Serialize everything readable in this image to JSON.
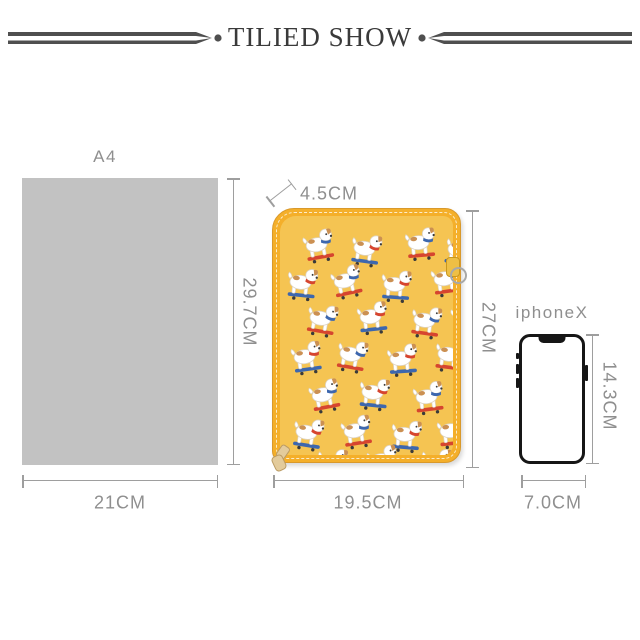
{
  "header": {
    "title": "TILIED SHOW"
  },
  "items": {
    "a4": {
      "name": "A4",
      "width_label": "21CM",
      "height_label": "29.7CM"
    },
    "case": {
      "thickness_label": "4.5CM",
      "width_label": "19.5CM",
      "height_label": "27CM",
      "pattern_description": "white terrier dogs riding red and blue skateboards on mustard yellow fabric"
    },
    "phone": {
      "name": "iphoneX",
      "width_label": "7.0CM",
      "height_label": "14.3CM"
    }
  },
  "icons": {
    "divider": "double-rule-with-arrow-and-dot",
    "d_ring": "metal-d-ring",
    "zipper_pull": "fabric-zipper-pull",
    "notch": "phone-notch"
  },
  "colors": {
    "ornament": "#4f4f4f",
    "title": "#3a3a3a",
    "a4_fill": "#c2c2c2",
    "dim": "#9e9e9e",
    "label": "#8f8f8f",
    "case_body": "#f5c452",
    "case_trim": "#f4af2a",
    "case_outline": "#d9992b",
    "dog_red": "#d6452f",
    "dog_blue": "#3d67ae",
    "dog_tan": "#cb9052",
    "phone_outline": "#161616"
  }
}
